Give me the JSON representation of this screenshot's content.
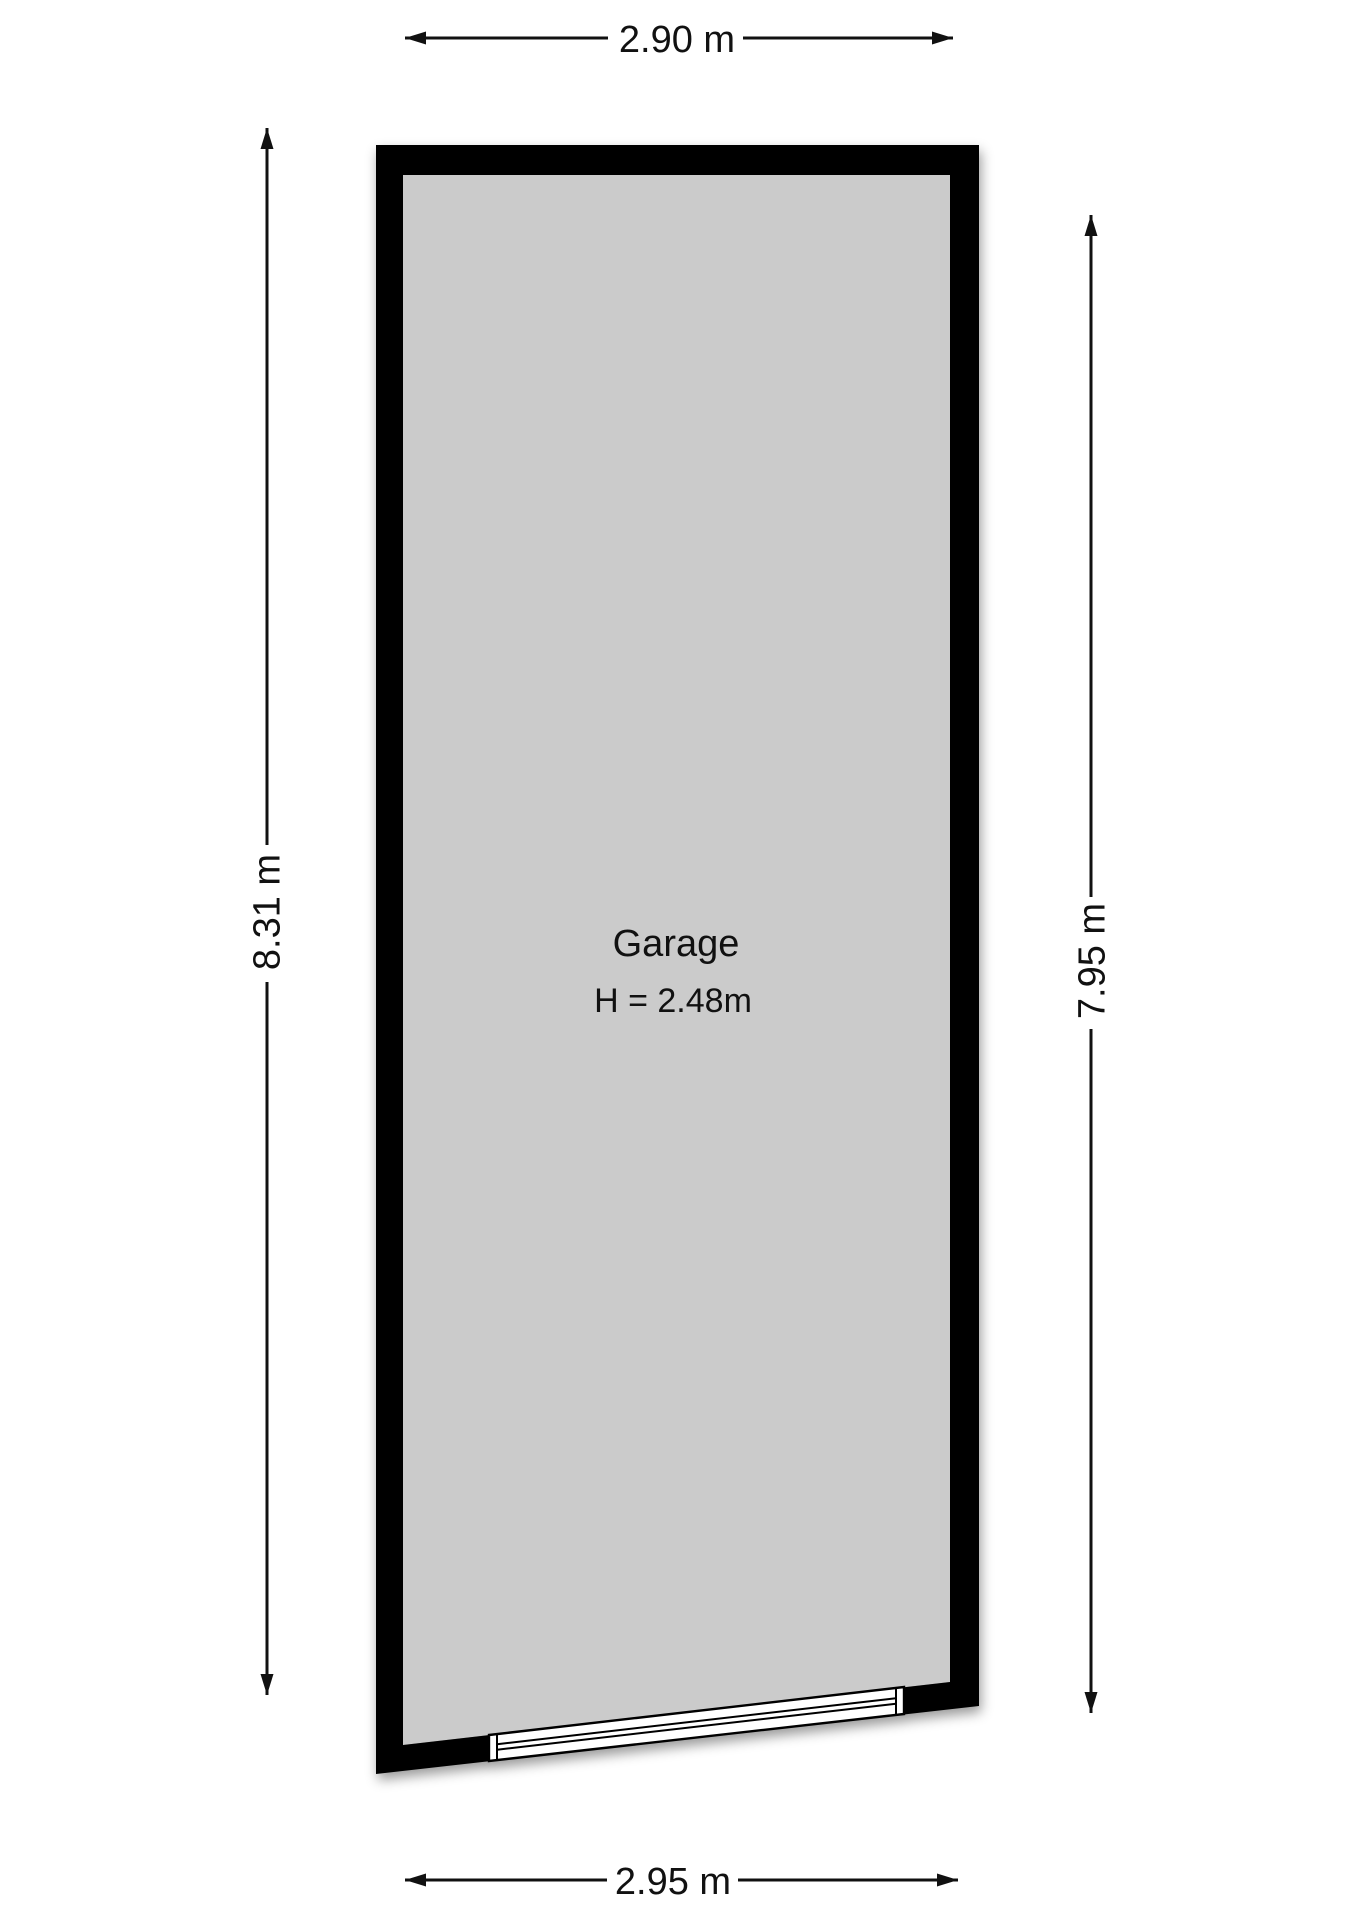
{
  "room": {
    "name": "Garage",
    "ceiling_height": "H = 2.48m"
  },
  "dimensions": {
    "top_width": "2.90 m",
    "left_height": "8.31 m",
    "right_height": "7.95 m",
    "bottom_width": "2.95 m"
  },
  "colors": {
    "wall": "#000000",
    "floor": "#cbcbcb",
    "line": "#111111",
    "text": "#111111",
    "door_fill": "#ffffff",
    "background": "#ffffff"
  }
}
